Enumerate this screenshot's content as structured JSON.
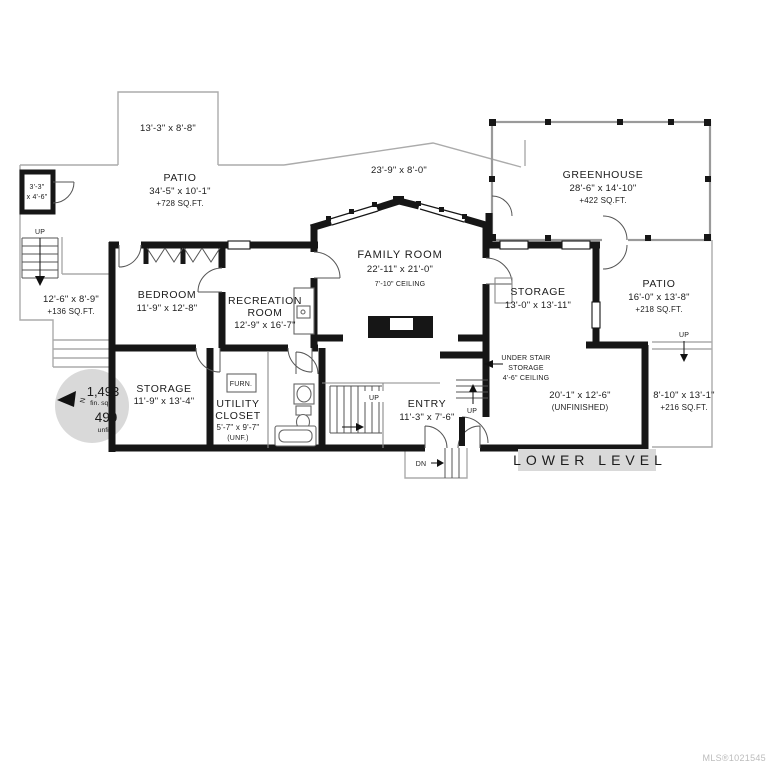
{
  "plan": {
    "level_badge": "LOWER LEVEL",
    "mls": "MLS®1021545",
    "north_letter": "N",
    "area_badge": {
      "fin_value": "1,493",
      "fin_unit": "fin. sq.ft.",
      "unfin_value": "490",
      "unfin_unit": "unfin."
    },
    "stair_up": "UP",
    "stair_dn": "DN",
    "furnace": "FURN.",
    "rooms": {
      "patio_top": {
        "dims": "13'-3\" x 8'-8\""
      },
      "patio_main": {
        "name": "PATIO",
        "dims": "34'-5\" x 10'-1\"",
        "area": "+728 SQ.FT."
      },
      "landing": {
        "dims_line1": "3'-3\"",
        "dims_line2": "x 4'-6\""
      },
      "patio_left": {
        "dims": "12'-6\" x 8'-9\"",
        "area": "+136 SQ.FT."
      },
      "deck": {
        "dims": "23'-9\" x 8'-0\""
      },
      "greenhouse": {
        "name": "GREENHOUSE",
        "dims": "28'-6\" x 14'-10\"",
        "area": "+422 SQ.FT."
      },
      "patio_right": {
        "name": "PATIO",
        "dims": "16'-0\" x 13'-8\"",
        "area": "+218 SQ.FT."
      },
      "patio_lower_right": {
        "dims": "8'-10\" x 13'-1\"",
        "area": "+216 SQ.FT."
      },
      "bedroom": {
        "name": "BEDROOM",
        "dims": "11'-9\" x 12'-8\""
      },
      "recreation": {
        "name1": "RECREATION",
        "name2": "ROOM",
        "dims": "12'-9\" x 16'-7\""
      },
      "family": {
        "name": "FAMILY ROOM",
        "dims": "22'-11\" x 21'-0\"",
        "ceiling": "7'-10\" CEILING"
      },
      "storage_right": {
        "name": "STORAGE",
        "dims": "13'-0\" x 13'-11\""
      },
      "storage_left": {
        "name": "STORAGE",
        "dims": "11'-9\" x 13'-4\""
      },
      "utility": {
        "name1": "UTILITY",
        "name2": "CLOSET",
        "dims": "5'-7\" x 9'-7\"",
        "note": "(UNF.)"
      },
      "entry": {
        "name": "ENTRY",
        "dims": "11'-3\" x 7'-6\""
      },
      "under_stair": {
        "line1": "UNDER STAIR",
        "line2": "STORAGE",
        "line3": "4'-6\" CEILING"
      },
      "unfinished": {
        "dims": "20'-1\" x 12'-6\"",
        "note": "(UNFINISHED)"
      }
    },
    "colors": {
      "wall": "#161616",
      "outdoor_line": "#ababab",
      "badge_bg": "#d9d9d9",
      "text": "#1c1c1c",
      "mls_text": "#bcbcbc"
    }
  }
}
